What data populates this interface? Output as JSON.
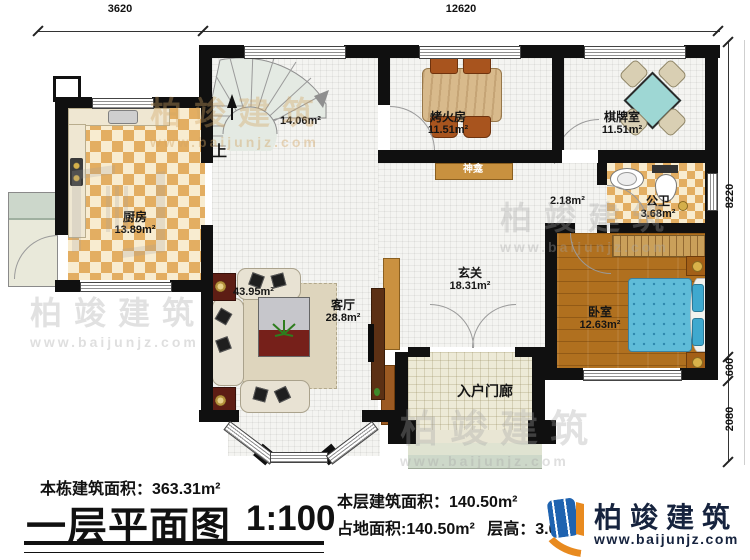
{
  "dimensions": {
    "top_left": "3620",
    "top_right": "12620",
    "right_top": "8220",
    "right_mid": "600",
    "right_bottom": "2080"
  },
  "rooms": {
    "stair_hall": {
      "area": "14.06m²",
      "direction": "上"
    },
    "kitchen": {
      "name": "厨房",
      "area": "13.89m²"
    },
    "fire_room": {
      "name": "烤火房",
      "area": "11.51m²"
    },
    "chess_room": {
      "name": "棋牌室",
      "area": "11.51m²"
    },
    "shrine": {
      "name": "神龛"
    },
    "hall_passage": {
      "area": "2.18m²"
    },
    "bathroom": {
      "name": "公卫",
      "area": "3.68m²"
    },
    "foyer": {
      "name": "玄关",
      "area": "18.31m²"
    },
    "living_room": {
      "name": "客厅",
      "area": "28.8m²",
      "combined_area": "43.95m²"
    },
    "bedroom": {
      "name": "卧室",
      "area": "12.63m²"
    },
    "entry_porch": {
      "name": "入户门廊"
    }
  },
  "footer": {
    "building_total_area": "本栋建筑面积：363.31m²",
    "plan_title": "一层平面图",
    "scale": "1:100",
    "floor_area": "本层建筑面积：140.50m²",
    "footprint_area": "占地面积:140.50m²",
    "floor_height": "层高：3.0m",
    "brand_name": "柏竣建筑",
    "brand_site": "www.baijunjz.com"
  },
  "watermark": {
    "brand": "柏竣建筑",
    "site": "www.baijunjz.com"
  }
}
